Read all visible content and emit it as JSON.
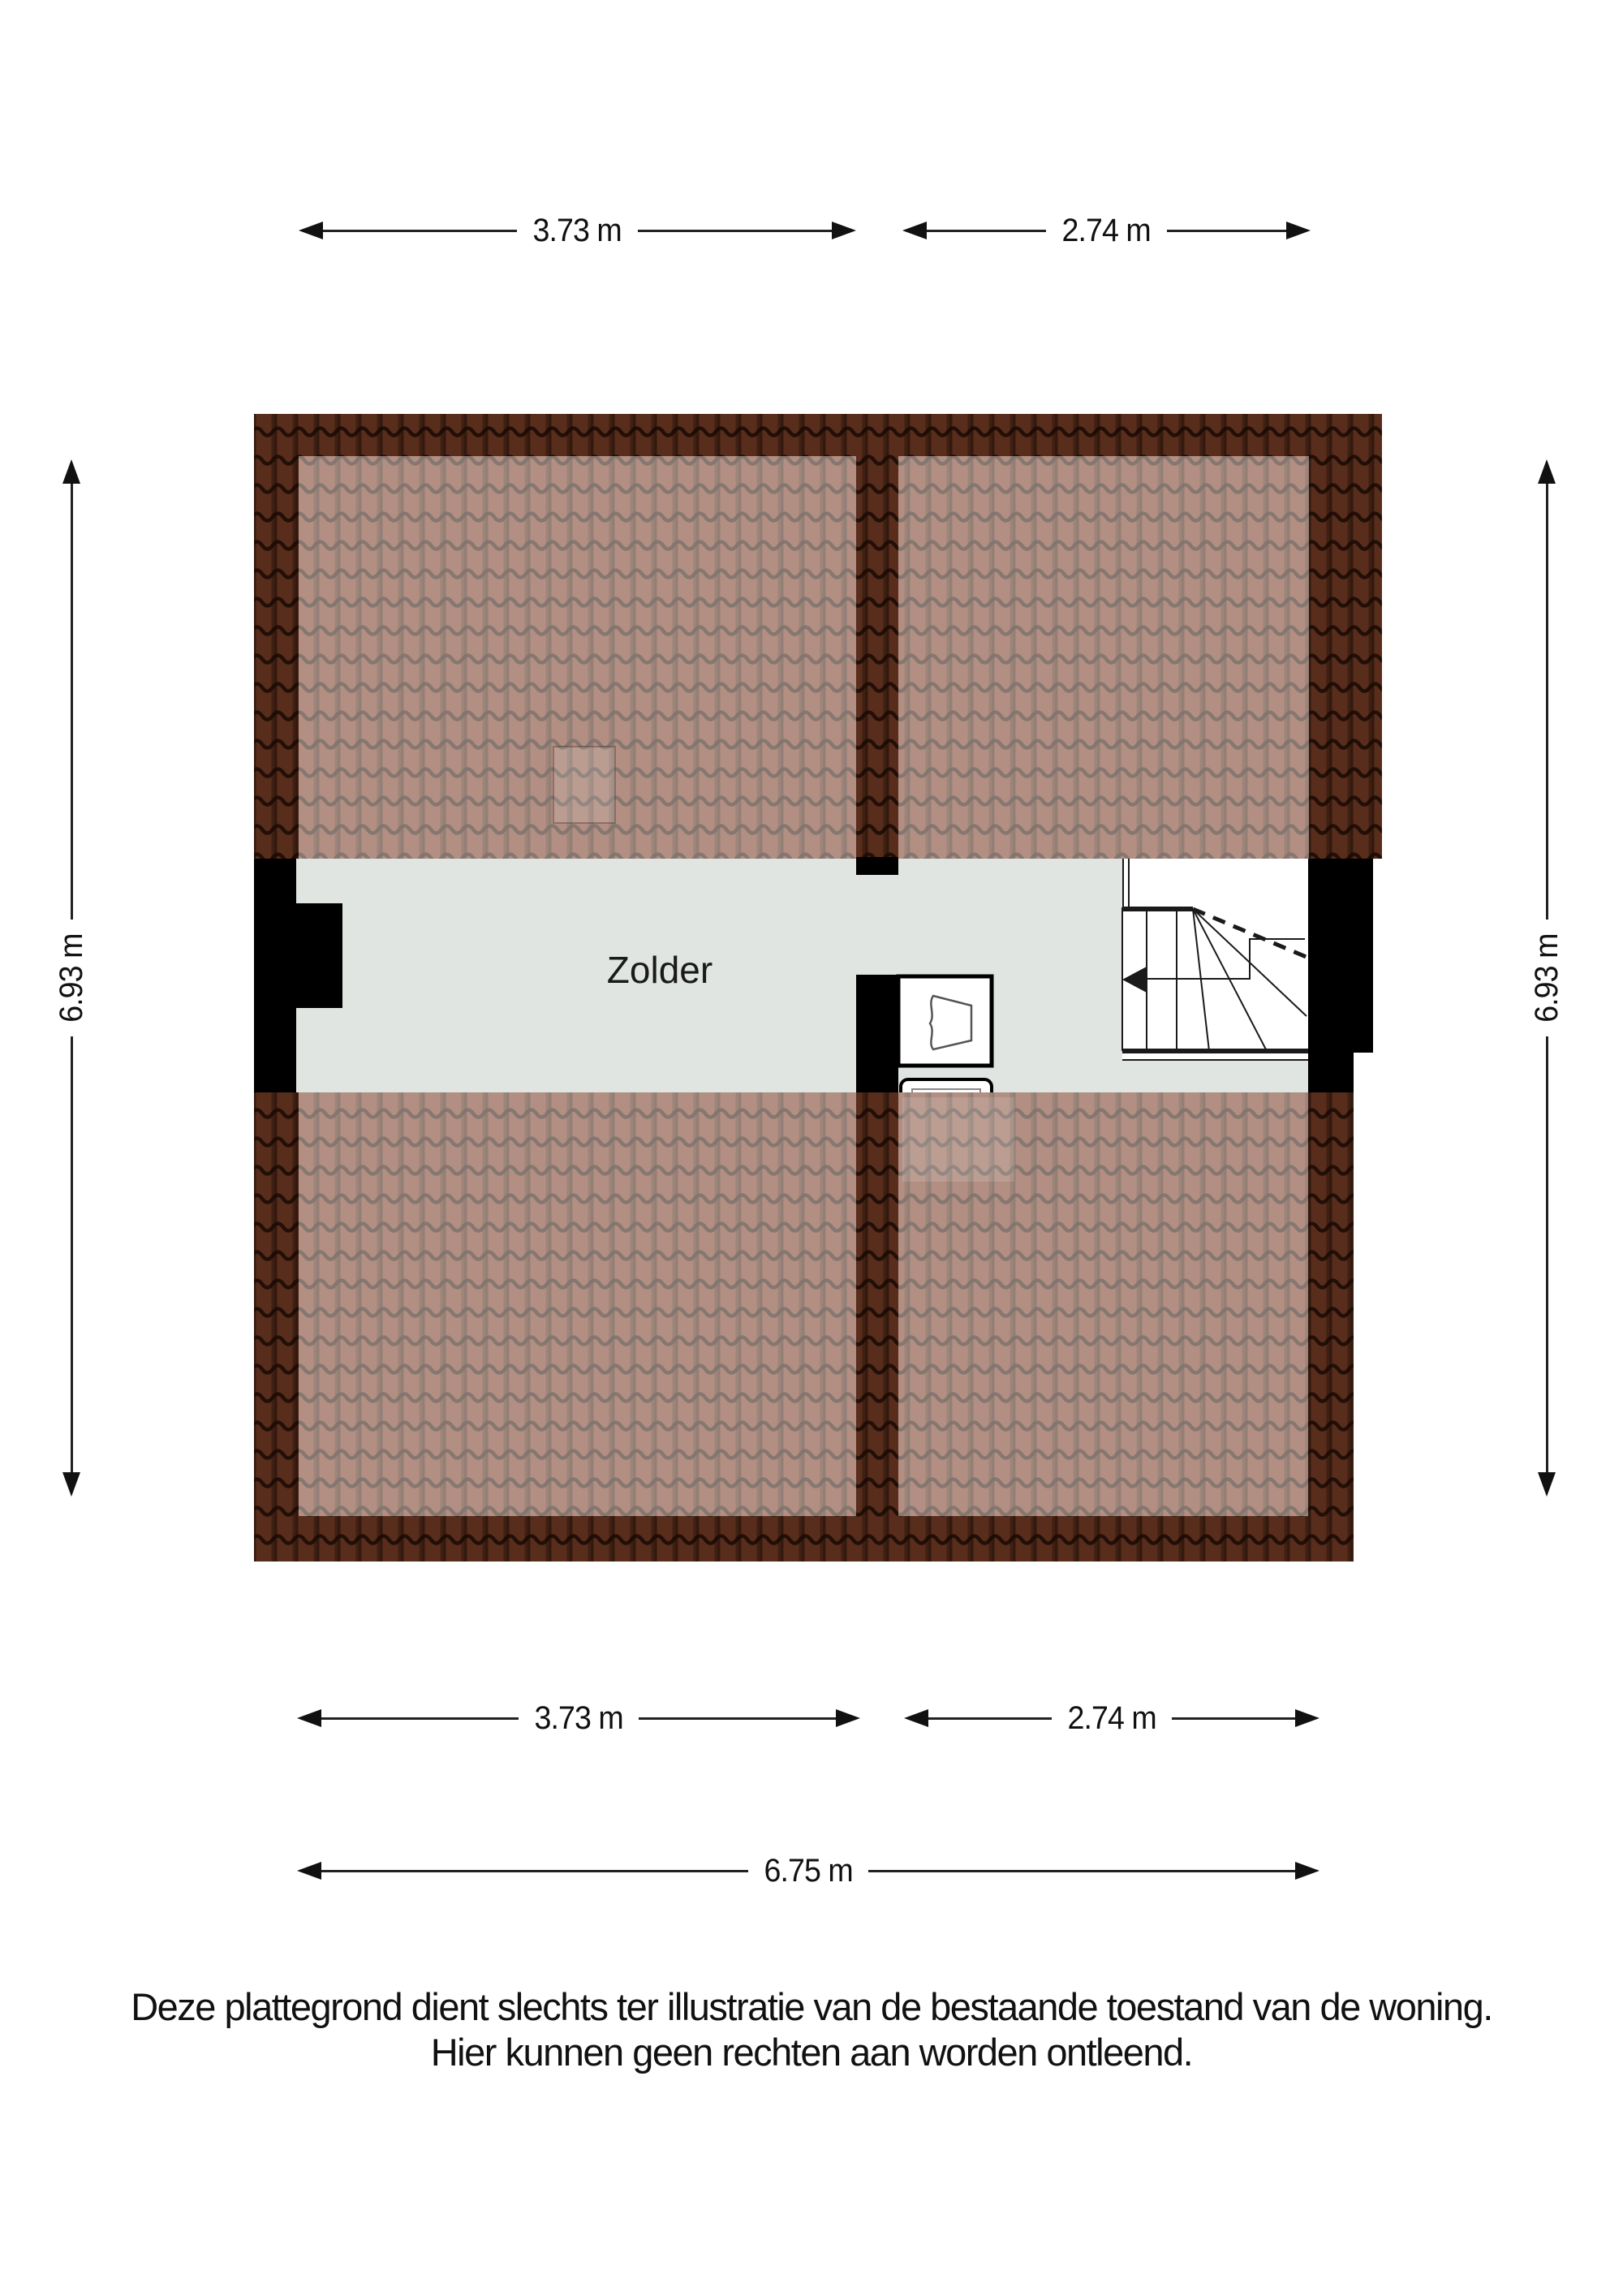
{
  "page": {
    "background": "#ffffff"
  },
  "floorplan": {
    "room_label": "Zolder",
    "dimensions": {
      "top": [
        {
          "label": "3.73 m"
        },
        {
          "label": "2.74 m"
        }
      ],
      "bottom": [
        {
          "label": "3.73 m"
        },
        {
          "label": "2.74 m"
        }
      ],
      "bottom_total": {
        "label": "6.75 m"
      },
      "left": {
        "label": "6.93 m"
      },
      "right": {
        "label": "6.93 m"
      }
    },
    "colors": {
      "roof_tile_base": "#7a3f28",
      "roof_tile_gap": "rgba(30,12,4,0.55)",
      "roof_border_shade": "rgba(0,0,0,0.28)",
      "roof_inner_highlight": "rgba(255,255,255,0.42)",
      "floor": "#e0e5e2",
      "wall": "#000000"
    }
  },
  "disclaimer": {
    "line1": "Deze plattegrond dient slechts ter illustratie van de bestaande toestand van de woning.",
    "line2": "Hier kunnen geen rechten aan worden ontleend."
  }
}
